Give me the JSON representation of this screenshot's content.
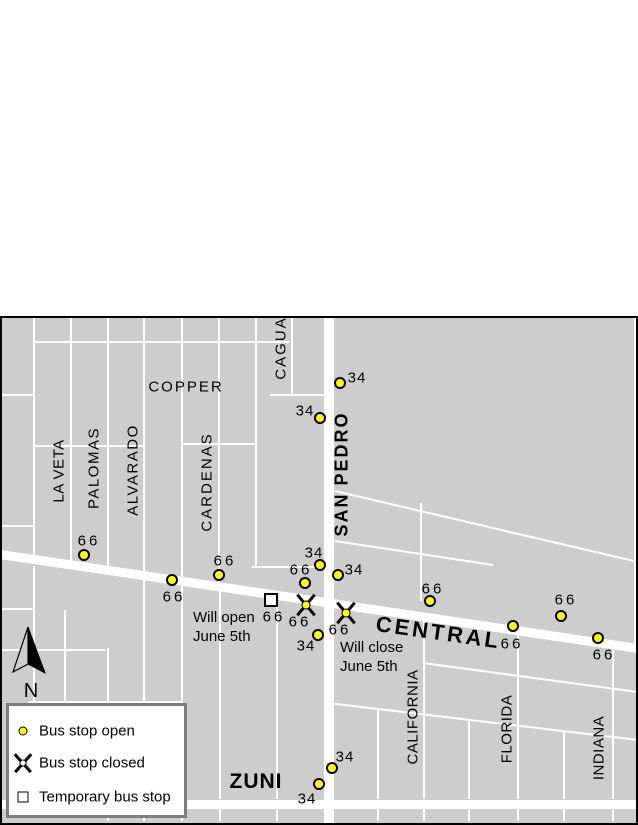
{
  "colors": {
    "page_bg": "#ffffff",
    "map_bg": "#cdcdcd",
    "street": "#ffffff",
    "stop_open_fill": "#ffff00",
    "symbol_outline": "#000000",
    "map_border": "#000000",
    "legend_border": "#7d7d7d",
    "legend_bg": "#ffffff"
  },
  "map": {
    "x": 0,
    "y": 316,
    "width": 638,
    "height": 509
  },
  "streets": {
    "central": {
      "name": "CENTRAL",
      "from": [
        0,
        554
      ],
      "to": [
        638,
        648
      ],
      "width": 9
    },
    "san_pedro": {
      "name": "SAN PEDRO",
      "x": 324,
      "width": 10,
      "top": 316,
      "bottom": 825
    },
    "zuni": {
      "name": "ZUNI",
      "y": 800,
      "height": 9,
      "left": 0,
      "right": 638
    },
    "minor_vertical": [
      [
        33,
        318,
        560
      ],
      [
        70,
        318,
        565
      ],
      [
        107,
        318,
        570
      ],
      [
        143,
        318,
        576
      ],
      [
        181,
        318,
        581
      ],
      [
        218,
        318,
        587
      ],
      [
        255,
        318,
        566
      ],
      [
        291,
        318,
        395
      ],
      [
        634,
        318,
        644
      ],
      [
        420,
        503,
        601
      ],
      [
        33,
        566,
        799
      ],
      [
        64,
        610,
        703
      ],
      [
        107,
        648,
        799
      ],
      [
        143,
        579,
        799
      ],
      [
        181,
        584,
        799
      ],
      [
        219,
        590,
        799
      ],
      [
        276,
        600,
        799
      ],
      [
        377,
        709,
        799
      ],
      [
        423,
        618,
        799
      ],
      [
        468,
        720,
        799
      ],
      [
        517,
        632,
        799
      ],
      [
        563,
        731,
        799
      ],
      [
        612,
        650,
        799
      ],
      [
        107,
        809,
        821
      ],
      [
        143,
        809,
        821
      ],
      [
        181,
        809,
        821
      ],
      [
        219,
        809,
        821
      ],
      [
        276,
        809,
        821
      ],
      [
        377,
        809,
        821
      ],
      [
        423,
        809,
        821
      ],
      [
        468,
        809,
        821
      ],
      [
        517,
        809,
        821
      ],
      [
        563,
        809,
        821
      ],
      [
        612,
        809,
        821
      ]
    ],
    "minor_horizontal": [
      [
        341,
        33,
        289
      ],
      [
        394,
        0,
        33
      ],
      [
        394,
        270,
        324
      ],
      [
        445,
        33,
        143
      ],
      [
        443,
        182,
        255
      ],
      [
        525,
        0,
        33
      ],
      [
        566,
        252,
        324
      ],
      [
        608,
        0,
        33
      ],
      [
        649,
        0,
        105
      ],
      [
        701,
        28,
        182
      ]
    ],
    "alleys": [
      [
        335,
        491,
        638,
        562
      ],
      [
        335,
        541,
        493,
        565
      ],
      [
        423,
        663,
        638,
        692
      ],
      [
        328,
        703,
        638,
        740
      ]
    ]
  },
  "street_labels": [
    {
      "text": "COPPER",
      "x": 186,
      "y": 387,
      "rot": 0,
      "bold": false,
      "size": 15,
      "ls": 2
    },
    {
      "text": "LA VETA",
      "x": 59,
      "y": 471,
      "rot": -90,
      "bold": false,
      "size": 15,
      "ls": 0.5
    },
    {
      "text": "PALOMAS",
      "x": 94,
      "y": 468,
      "rot": -90,
      "bold": false,
      "size": 15,
      "ls": 1.5
    },
    {
      "text": "ALVARADO",
      "x": 133,
      "y": 470,
      "rot": -90,
      "bold": false,
      "size": 15,
      "ls": 1.5
    },
    {
      "text": "CARDENAS",
      "x": 207,
      "y": 482,
      "rot": -90,
      "bold": false,
      "size": 15,
      "ls": 2
    },
    {
      "text": "CAGUA",
      "x": 281,
      "y": 348,
      "rot": -90,
      "bold": false,
      "size": 15,
      "ls": 2
    },
    {
      "text": "SAN PEDRO",
      "x": 342,
      "y": 474,
      "rot": -90,
      "bold": true,
      "size": 18,
      "ls": 2
    },
    {
      "text": "CALIFORNIA",
      "x": 413,
      "y": 717,
      "rot": -90,
      "bold": false,
      "size": 15,
      "ls": 0.5
    },
    {
      "text": "FLORIDA",
      "x": 507,
      "y": 729,
      "rot": -90,
      "bold": false,
      "size": 15,
      "ls": 0.5
    },
    {
      "text": "INDIANA",
      "x": 599,
      "y": 748,
      "rot": -90,
      "bold": false,
      "size": 15,
      "ls": 0.5
    },
    {
      "text": "CENTRAL",
      "x": 376,
      "y": 624,
      "rot": 8,
      "bold": true,
      "size": 22,
      "ls": 3,
      "anchor": "left"
    },
    {
      "text": "ZUNI",
      "x": 256,
      "y": 782,
      "rot": 0,
      "bold": true,
      "size": 21,
      "ls": 1
    }
  ],
  "bus_stops": {
    "open": [
      {
        "x": 84,
        "y": 555,
        "route": "66",
        "label_x": 89,
        "label_y": 541
      },
      {
        "x": 172,
        "y": 580,
        "route": "66",
        "label_x": 174,
        "label_y": 597
      },
      {
        "x": 219,
        "y": 575,
        "route": "66",
        "label_x": 225,
        "label_y": 561
      },
      {
        "x": 305,
        "y": 583,
        "route": "66",
        "label_x": 301,
        "label_y": 570
      },
      {
        "x": 430,
        "y": 601,
        "route": "66",
        "label_x": 433,
        "label_y": 589
      },
      {
        "x": 513,
        "y": 626,
        "route": "66",
        "label_x": 512,
        "label_y": 644
      },
      {
        "x": 561,
        "y": 616,
        "route": "66",
        "label_x": 566,
        "label_y": 600
      },
      {
        "x": 598,
        "y": 638,
        "route": "66",
        "label_x": 604,
        "label_y": 655
      },
      {
        "x": 340,
        "y": 383,
        "route": "34",
        "label_x": 357,
        "label_y": 378
      },
      {
        "x": 320,
        "y": 418,
        "route": "34",
        "label_x": 305,
        "label_y": 411
      },
      {
        "x": 320,
        "y": 565,
        "route": "34",
        "label_x": 314,
        "label_y": 553
      },
      {
        "x": 338,
        "y": 575,
        "route": "34",
        "label_x": 354,
        "label_y": 570
      },
      {
        "x": 318,
        "y": 635,
        "route": "34",
        "label_x": 306,
        "label_y": 646
      },
      {
        "x": 332,
        "y": 768,
        "route": "34",
        "label_x": 345,
        "label_y": 757
      },
      {
        "x": 319,
        "y": 784,
        "route": "34",
        "label_x": 307,
        "label_y": 799
      }
    ],
    "closed": [
      {
        "x": 306,
        "y": 605,
        "route": "66",
        "label_x": 300,
        "label_y": 622
      },
      {
        "x": 346,
        "y": 613,
        "route": "66",
        "label_x": 340,
        "label_y": 630
      }
    ],
    "temporary": [
      {
        "x": 271,
        "y": 600,
        "route": "66",
        "label_x": 274,
        "label_y": 617
      }
    ]
  },
  "annotations": [
    {
      "lines": [
        "Will open",
        "June 5th"
      ],
      "x": 193,
      "y": 608
    },
    {
      "lines": [
        "Will close",
        "June 5th"
      ],
      "x": 340,
      "y": 638
    }
  ],
  "legend": {
    "items": [
      {
        "symbol": "open",
        "label": "Bus stop open"
      },
      {
        "symbol": "closed",
        "label": "Bus stop closed"
      },
      {
        "symbol": "temporary",
        "label": "Temporary bus stop"
      }
    ]
  },
  "north_arrow": {
    "label": "N"
  }
}
